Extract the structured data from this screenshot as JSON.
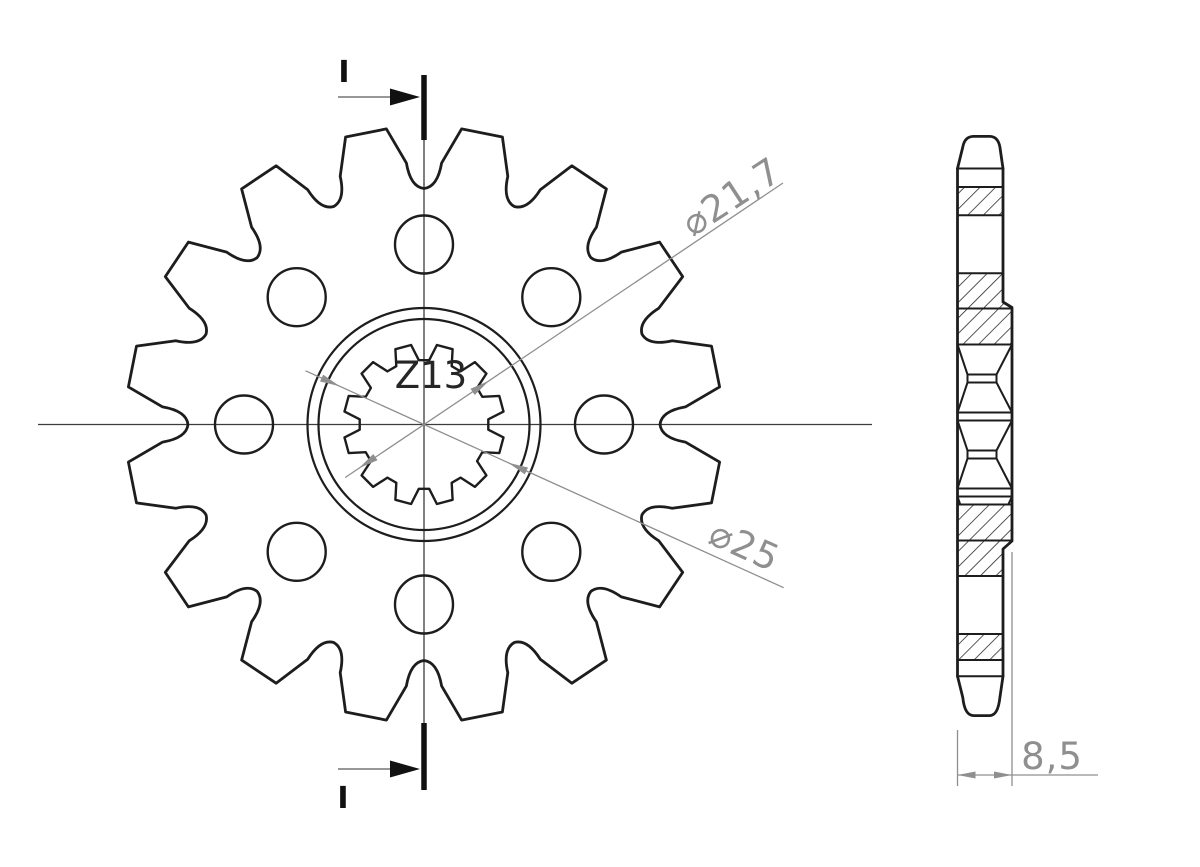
{
  "drawing": {
    "front_view": {
      "section_label_top": "I",
      "section_label_bottom": "I",
      "spline_label": "Z13",
      "spline_bore_diameter": "⌀21,7",
      "hub_diameter": "⌀25"
    },
    "side_view": {
      "width_dimension": "8,5"
    },
    "colors": {
      "outline": "#1d1d1d",
      "centerline": "#3c3c3c",
      "dimension": "#8f8f8f",
      "section_mark": "#111111",
      "background": "#ffffff"
    }
  }
}
